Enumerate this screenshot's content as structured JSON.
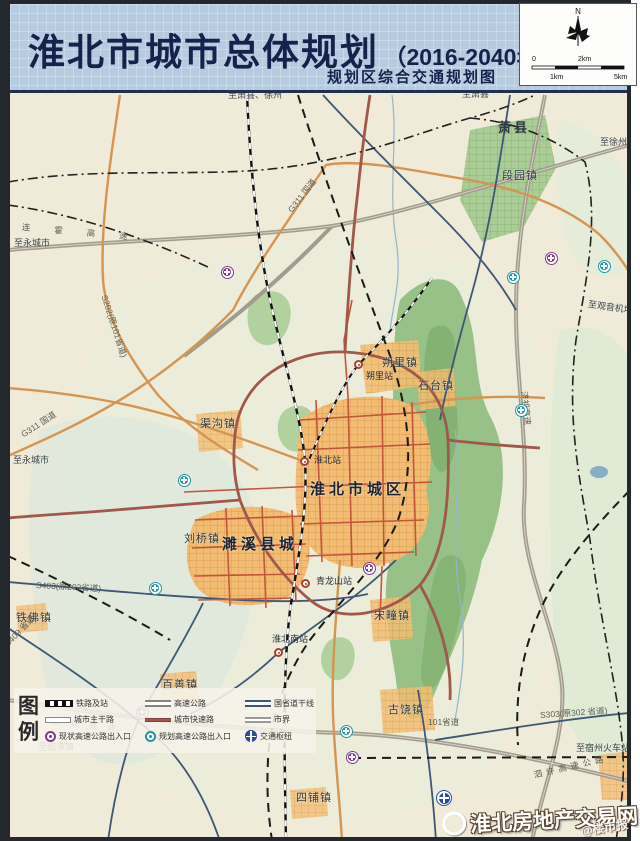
{
  "header": {
    "title": "淮北市城市总体规划",
    "title_suffix": "（2016-2040年）",
    "subtitle": "规划区综合交通规划图",
    "compass_label": "N",
    "scale": {
      "top_left": "0",
      "top_right": "2km",
      "bottom_left": "1km",
      "bottom_right": "5km"
    }
  },
  "legend": {
    "heading": "图例",
    "items": [
      {
        "symbol": "railway",
        "label": "铁路及站"
      },
      {
        "symbol": "expressway",
        "label": "高速公路"
      },
      {
        "symbol": "trunk",
        "label": "国省道干线"
      },
      {
        "symbol": "arterial",
        "label": "城市主干路"
      },
      {
        "symbol": "urban-expressway",
        "label": "城市快速路"
      },
      {
        "symbol": "boundary",
        "label": "市界"
      },
      {
        "symbol": "interchange-existing",
        "label": "现状高速公路出入口"
      },
      {
        "symbol": "interchange-planned",
        "label": "规划高速公路出入口"
      },
      {
        "symbol": "hub",
        "label": "交通枢纽"
      }
    ]
  },
  "map": {
    "labels": [
      {
        "t": "萧县",
        "x": 498,
        "y": 126,
        "c": "county",
        "r": 0
      },
      {
        "t": "段园镇",
        "x": 502,
        "y": 176,
        "c": "town",
        "r": 0
      },
      {
        "t": "朔里镇",
        "x": 382,
        "y": 363,
        "c": "town",
        "r": 0
      },
      {
        "t": "石台镇",
        "x": 418,
        "y": 386,
        "c": "town",
        "r": 0
      },
      {
        "t": "渠沟镇",
        "x": 200,
        "y": 424,
        "c": "town",
        "r": 0
      },
      {
        "t": "淮北市城区",
        "x": 310,
        "y": 487,
        "c": "city",
        "r": 0
      },
      {
        "t": "刘桥镇",
        "x": 184,
        "y": 539,
        "c": "town",
        "r": 0
      },
      {
        "t": "濉溪县城",
        "x": 222,
        "y": 542,
        "c": "city",
        "r": 0
      },
      {
        "t": "宋疃镇",
        "x": 374,
        "y": 616,
        "c": "town",
        "r": 0
      },
      {
        "t": "铁佛镇",
        "x": 16,
        "y": 618,
        "c": "town",
        "r": 0
      },
      {
        "t": "百善镇",
        "x": 162,
        "y": 685,
        "c": "town",
        "r": 0
      },
      {
        "t": "古饶镇",
        "x": 388,
        "y": 710,
        "c": "town",
        "r": 0
      },
      {
        "t": "四铺镇",
        "x": 296,
        "y": 798,
        "c": "town",
        "r": 0
      },
      {
        "t": "朔里站",
        "x": 366,
        "y": 377,
        "c": "station",
        "r": 0
      },
      {
        "t": "淮北站",
        "x": 314,
        "y": 461,
        "c": "station",
        "r": 0
      },
      {
        "t": "青龙山站",
        "x": 316,
        "y": 582,
        "c": "station",
        "r": 0
      },
      {
        "t": "淮北南站",
        "x": 272,
        "y": 640,
        "c": "station",
        "r": 0
      },
      {
        "t": "至萧县、徐州",
        "x": 228,
        "y": 96,
        "c": "dir",
        "r": 0
      },
      {
        "t": "至萧县",
        "x": 462,
        "y": 95,
        "c": "dir",
        "r": 0
      },
      {
        "t": "至徐州",
        "x": 600,
        "y": 143,
        "c": "dir",
        "r": 0
      },
      {
        "t": "至永城市",
        "x": 14,
        "y": 244,
        "c": "dir",
        "r": 0
      },
      {
        "t": "至永城市",
        "x": 13,
        "y": 461,
        "c": "dir",
        "r": 0
      },
      {
        "t": "至观音机场",
        "x": 588,
        "y": 305,
        "c": "dir",
        "r": 8
      },
      {
        "t": "至临涣镇",
        "x": 38,
        "y": 748,
        "c": "dir",
        "r": 0
      },
      {
        "t": "至宿州火车站",
        "x": 576,
        "y": 749,
        "c": "dir",
        "r": 0
      },
      {
        "t": "连霍高速",
        "x": 22,
        "y": 228,
        "c": "road",
        "r": 5,
        "ls": 24
      },
      {
        "t": "G311 国道",
        "x": 290,
        "y": 212,
        "c": "road",
        "r": -52
      },
      {
        "t": "S202(原101省道)",
        "x": 104,
        "y": 296,
        "c": "road",
        "r": 72
      },
      {
        "t": "G311 国道",
        "x": 22,
        "y": 436,
        "c": "road",
        "r": -33
      },
      {
        "t": "S403(原202省道)",
        "x": 36,
        "y": 586,
        "c": "road",
        "r": 3
      },
      {
        "t": "S409 省道",
        "x": 6,
        "y": 646,
        "c": "road",
        "r": -46
      },
      {
        "t": "济祁高速",
        "x": 524,
        "y": 392,
        "c": "road",
        "r": 84
      },
      {
        "t": "泗许高速",
        "x": 52,
        "y": 722,
        "c": "road",
        "r": 6,
        "ls": 10
      },
      {
        "t": "101省道",
        "x": 428,
        "y": 723,
        "c": "road",
        "r": 0
      },
      {
        "t": "S303(原302 省道)",
        "x": 540,
        "y": 716,
        "c": "road",
        "r": -4
      },
      {
        "t": "泗许高速公路",
        "x": 534,
        "y": 776,
        "c": "road",
        "r": -13,
        "ls": 4
      }
    ],
    "stations": [
      {
        "name": "shuoli-station",
        "x": 358,
        "y": 364
      },
      {
        "name": "huaibei-station",
        "x": 304,
        "y": 461
      },
      {
        "name": "qinglongshan-station",
        "x": 305,
        "y": 583
      },
      {
        "name": "huaibei-south-station",
        "x": 278,
        "y": 652
      }
    ],
    "interchanges": [
      {
        "type": "existing",
        "x": 227,
        "y": 272
      },
      {
        "type": "existing",
        "x": 551,
        "y": 258
      },
      {
        "type": "existing",
        "x": 369,
        "y": 568
      },
      {
        "type": "existing",
        "x": 142,
        "y": 712
      },
      {
        "type": "existing",
        "x": 352,
        "y": 757
      },
      {
        "type": "planned",
        "x": 513,
        "y": 277
      },
      {
        "type": "planned",
        "x": 184,
        "y": 480
      },
      {
        "type": "planned",
        "x": 155,
        "y": 588
      },
      {
        "type": "planned",
        "x": 521,
        "y": 410
      },
      {
        "type": "planned",
        "x": 346,
        "y": 731
      },
      {
        "type": "planned",
        "x": 604,
        "y": 266
      },
      {
        "type": "hub",
        "x": 444,
        "y": 798
      }
    ]
  },
  "watermark": {
    "main": "淮北房地产交易网",
    "secondary": "@楼市报"
  },
  "colors": {
    "header_bg": "#b6cbdf",
    "title_text": "#16224c",
    "map_bg": "#f0ead9",
    "expressway": "#a29c8e",
    "national_road": "#d59552",
    "trunk_road": "#3d5775",
    "urban_expressway": "#a0584a",
    "arterial": "#c2563c",
    "mountain_green": "#97c186",
    "urban_area": "#f2bd72",
    "existing_interchange": "#7d3a90",
    "planned_interchange": "#1f96a0",
    "hub": "#2c4a9c"
  }
}
